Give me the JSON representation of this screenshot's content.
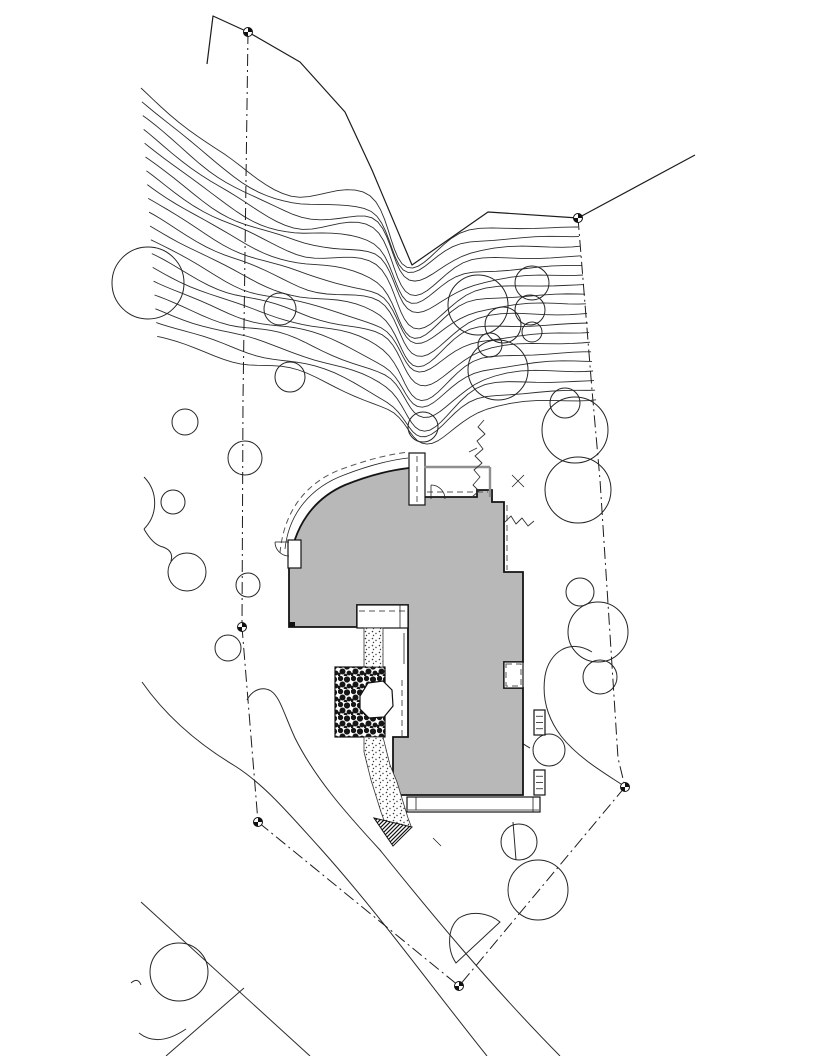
{
  "meta": {
    "type": "architectural-site-plan",
    "canvas": {
      "w": 816,
      "h": 1056
    }
  },
  "colors": {
    "background": "#ffffff",
    "building_fill": "#b8b8b8",
    "line": "#222222",
    "wall_gray": "#8f8f8f"
  },
  "contours": {
    "count": 19,
    "start_x": 141,
    "start_y": 88,
    "dx": 0.9,
    "dy": 13.8,
    "slope0": 0.86,
    "slope_step": 0.031,
    "end_y0": 227,
    "end_y_step": 9.6,
    "shelf_x0": 370,
    "shelf_y0": 195,
    "shelf_dy": 12.0,
    "valley_x0": 407,
    "valley_y0": 263,
    "valley_dy": 10.3,
    "rise_x0": 469,
    "rise_y0": 233,
    "rise_dy": 9.7
  },
  "fence": {
    "points": [
      [
        207,
        64
      ],
      [
        213,
        16
      ],
      [
        248,
        32
      ],
      [
        300,
        62
      ],
      [
        345,
        112
      ],
      [
        372,
        170
      ],
      [
        412,
        265
      ],
      [
        488,
        212
      ],
      [
        578,
        218
      ],
      [
        695,
        155
      ]
    ]
  },
  "boundaries": [
    {
      "name": "property-line-west",
      "points": [
        [
          248,
          32
        ],
        [
          243,
          400
        ],
        [
          242,
          627
        ],
        [
          258,
          822
        ],
        [
          459,
          986
        ]
      ]
    },
    {
      "name": "property-line-east",
      "points": [
        [
          578,
          218
        ],
        [
          592,
          390
        ],
        [
          600,
          480
        ],
        [
          618,
          758
        ],
        [
          625,
          787
        ],
        [
          459,
          986
        ]
      ]
    }
  ],
  "roads": [
    {
      "name": "road-edge-1",
      "points": [
        [
          141,
          902
        ],
        [
          310,
          1056
        ]
      ]
    },
    {
      "name": "road-edge-2",
      "points": [
        [
          244,
          988
        ],
        [
          166,
          1056
        ]
      ]
    }
  ],
  "curves": [
    {
      "name": "slope-toe-line",
      "d": "M142,682 C170,722 205,748 235,766 C265,785 290,815 320,848 C380,915 430,985 487,1056"
    },
    {
      "name": "driveway-edge",
      "d": "M247,700 C252,690 262,686 271,691 C280,697 284,714 295,738 C315,778 345,812 380,850 C430,912 490,985 560,1056"
    },
    {
      "name": "swale-line",
      "d": "M592,652 C570,638 549,652 545,676 C542,696 546,716 561,736 C578,758 606,774 624,786"
    },
    {
      "name": "garden-curve",
      "d": "M507,725 C513,736 519,742 530,748"
    },
    {
      "name": "tree-arc",
      "d": "M144,477 A37,37 0 0 1 144,529"
    },
    {
      "name": "arc-tail",
      "d": "M144,529 Q153,545 163,547 Q174,551 171,561"
    },
    {
      "name": "shrub-arc",
      "d": "M139,1033 Q158,1048 186,1029"
    },
    {
      "name": "twig",
      "d": "M131,983 Q138,977 141,985"
    },
    {
      "name": "stem",
      "d": "M513,822 L516,860"
    }
  ],
  "veg": [
    {
      "name": "hedge-vine",
      "d": "M484,420 L478,427 L485,434 L477,441 L483,449 L475,456 L482,463 L474,470 L480,477 L473,485 L479,491 L472,497"
    },
    {
      "name": "hedge-spur",
      "d": "M477,448 L469,452"
    },
    {
      "name": "scrub-line",
      "d": "M505,522 L511,516 L516,524 L522,518 L528,526 L534,521"
    }
  ],
  "shrub_blob": {
    "d": "M459,918 C472,910 489,913 500,922 L456,963 C447,950 447,928 459,918 Z"
  },
  "trees": [
    [
      148,
      283,
      36
    ],
    [
      280,
      309,
      16
    ],
    [
      290,
      377,
      15
    ],
    [
      185,
      422,
      13
    ],
    [
      423,
      427,
      15
    ],
    [
      245,
      458,
      17
    ],
    [
      173,
      502,
      12
    ],
    [
      187,
      572,
      19
    ],
    [
      248,
      585,
      12
    ],
    [
      228,
      648,
      13
    ],
    [
      478,
      305,
      30
    ],
    [
      532,
      283,
      17
    ],
    [
      530,
      310,
      15
    ],
    [
      503,
      325,
      18
    ],
    [
      532,
      332,
      10
    ],
    [
      490,
      345,
      12
    ],
    [
      498,
      370,
      30
    ],
    [
      565,
      403,
      15
    ],
    [
      575,
      430,
      33
    ],
    [
      578,
      490,
      33
    ],
    [
      580,
      592,
      14
    ],
    [
      598,
      632,
      30
    ],
    [
      600,
      677,
      17
    ],
    [
      549,
      750,
      16
    ],
    [
      519,
      842,
      18
    ],
    [
      538,
      890,
      30
    ],
    [
      179,
      972,
      29
    ]
  ],
  "markers": [
    [
      248,
      32
    ],
    [
      578,
      218
    ],
    [
      242,
      627
    ],
    [
      258,
      822
    ],
    [
      625,
      787
    ],
    [
      459,
      986
    ]
  ],
  "annotations": {
    "x_mark": {
      "cx": 518,
      "cy": 481,
      "r": 6
    },
    "tick": [
      [
        433,
        838
      ],
      [
        441,
        846
      ]
    ]
  },
  "building": {
    "footprint_d": "M289,568 C293,525 315,498 345,485 C372,474 392,470 409,468 L424,468 L424,497 L477,497 L477,490 L492,490 L492,502 L504,502 L504,572 L523,572 L523,662 L504,662 L504,688 L523,688 L523,795 L393,795 L393,737 L408,737 L408,605 L357,605 L357,627 L289,627 Z",
    "eave_solid_d": "M285,549 C289,512 312,487 344,475 C370,465 391,460 408,458",
    "eave_dashed_d": "M280,553 C284,508 309,481 342,469 C369,459 391,454 409,452",
    "chimney": {
      "x": 409,
      "y": 453,
      "w": 16,
      "h": 52,
      "dash_x": 417,
      "dash_y1": 456,
      "dash_y2": 502
    },
    "garden_wall": [
      [
        [
          424,
          467
        ],
        [
          490,
          467
        ]
      ],
      [
        [
          490,
          467
        ],
        [
          490,
          497
        ]
      ]
    ],
    "garden_dash": [
      [
        427,
        492
      ],
      [
        488,
        492
      ]
    ],
    "right_dash": [
      [
        507,
        505
      ],
      [
        507,
        570
      ]
    ],
    "door1": {
      "leaf": [
        [
          431,
          485
        ],
        [
          431,
          499
        ]
      ],
      "arc_d": "M431,485 A14,14 0 0 1 445,499"
    },
    "door2": {
      "notch": {
        "x": 288,
        "y": 540,
        "w": 13,
        "h": 28
      },
      "leaf": [
        [
          289,
          542
        ],
        [
          275,
          542
        ]
      ],
      "arc_d": "M275,542 A14,14 0 0 0 289,556"
    },
    "landing": {
      "x": 357,
      "y": 605,
      "w": 51,
      "h": 23,
      "dash": [
        [
          359,
          611
        ],
        [
          406,
          611
        ]
      ],
      "vline": [
        [
          400,
          605
        ],
        [
          400,
          628
        ]
      ]
    },
    "court_line": [
      [
        404,
        633
      ],
      [
        404,
        664
      ]
    ],
    "court_dash": [
      [
        402,
        680
      ],
      [
        402,
        736
      ]
    ],
    "cobble": {
      "x": 335,
      "y": 667,
      "w": 50,
      "h": 70
    },
    "boulder_d": "M360,696 L368,683 L383,681 L392,690 L393,706 L384,717 L369,718 L360,709 Z",
    "stipple1": {
      "x": 364,
      "y": 628,
      "w": 19,
      "h": 39
    },
    "stipple2_d": "M364,737 L383,737 L390,765 L397,782 L408,818 L411,826 L393,845 L381,812 L371,780 L364,752 Z",
    "hatch_tri_d": "M374,818 L412,827 L393,846 Z",
    "notch_right": {
      "x": 504,
      "y": 662,
      "w": 19,
      "h": 26,
      "dash": {
        "x": 506,
        "y": 664,
        "w": 15,
        "h": 22
      }
    },
    "deck": {
      "x": 407,
      "y": 797,
      "w": 133,
      "h": 15,
      "inner_y": 810,
      "v1": 416,
      "v2": 533
    },
    "corner_sq": {
      "x": 289,
      "y": 622,
      "w": 6,
      "h": 5
    },
    "steps": [
      {
        "x": 534,
        "y": 710,
        "w": 11,
        "h": 25
      },
      {
        "x": 534,
        "y": 770,
        "w": 11,
        "h": 25
      }
    ]
  }
}
